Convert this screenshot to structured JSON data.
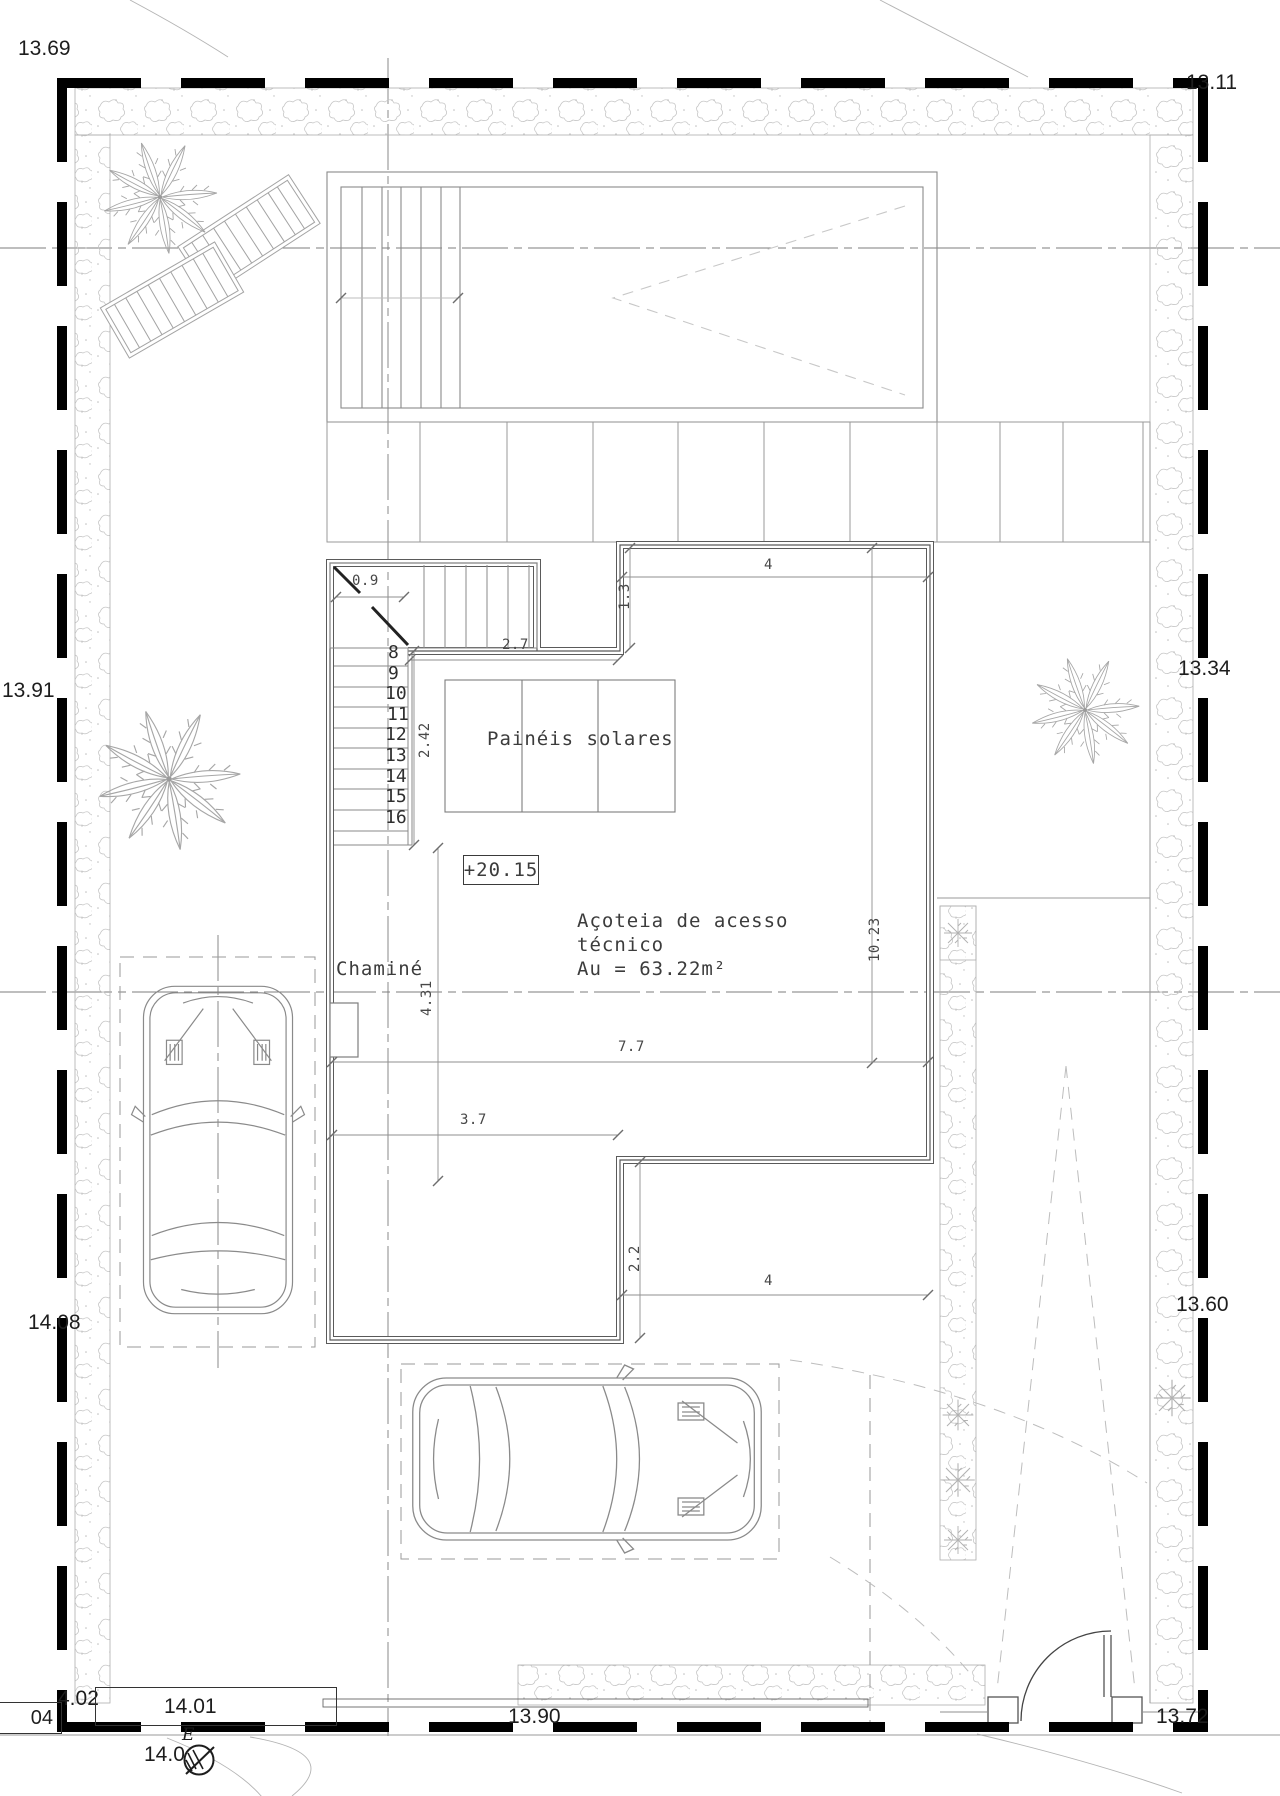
{
  "plan": {
    "annotations": {
      "level_marker": "+20.15",
      "solar_panels": "Painéis solares",
      "chimney": "Chaminé",
      "terrace_line1": "Açoteia de acesso",
      "terrace_line2": "técnico",
      "terrace_area": "Au = 63.22m²"
    },
    "dimensions": {
      "stair_landing": "0.9",
      "stair_run_top": "2.7",
      "parapet_jog": "1.3",
      "roof_top_width": "4",
      "stair_flight": "2.42",
      "west_wall": "4.31",
      "east_parapet": "10.23",
      "roof_width": "7.7",
      "block_width": "3.7",
      "block_depth": "2.2",
      "roof_bottom_width": "4"
    },
    "stair_numbers": [
      "8",
      "9",
      "10",
      "11",
      "12",
      "13",
      "14",
      "15",
      "16"
    ],
    "spot_elevations": {
      "top_left": "13.69",
      "top_right": "13.11",
      "west": "13.91",
      "east": "13.34",
      "west_lower": "14.08",
      "east_lower": "13.60",
      "bottom_center": "13.90",
      "bottom_right": "13.72",
      "bottom_left": "4.02",
      "bench_box": "14.01",
      "edge_box": "04",
      "survey_value": "14.0",
      "survey_letter": "E"
    }
  },
  "colors": {
    "paper": "#ffffff",
    "boundary_ink": "#000000",
    "ink": "#3a3a3a",
    "wall_ink": "#5a5a5a",
    "light_ink": "#8f8f8f",
    "veg_ink": "#c0c0c0"
  }
}
